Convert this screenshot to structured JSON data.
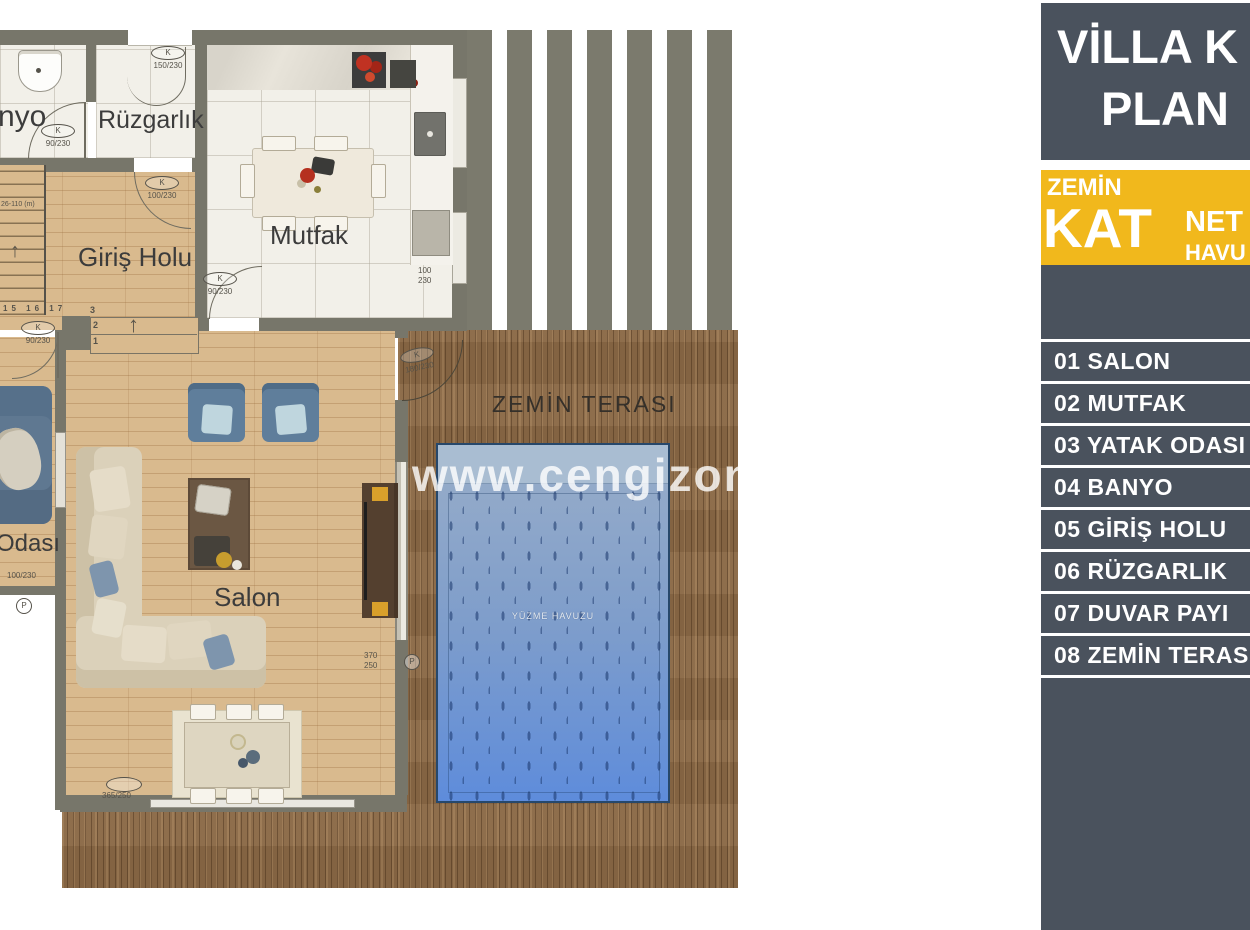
{
  "sidebar": {
    "title_line1": "VİLLA K",
    "title_line2": "PLAN",
    "banner": {
      "floor_word": "ZEMİN",
      "floor_big": "KAT",
      "right_top": "NET",
      "right_bottom": "HAVU"
    },
    "legend": [
      "01 SALON",
      "02 MUTFAK",
      "03 YATAK ODASI",
      "04 BANYO",
      "05 GİRİŞ HOLU",
      "06 RÜZGARLIK",
      "07 DUVAR PAYI",
      "08 ZEMİN TERASI"
    ]
  },
  "plan": {
    "watermark": "www.cengizonay.c",
    "labels": {
      "banyo": "nyo",
      "ruzgarlik": "Rüzgarlık",
      "mutfak": "Mutfak",
      "giris_holu": "Giriş Holu",
      "yatak_odasi": "Odası",
      "salon": "Salon",
      "terrace": "ZEMİN TERASI",
      "pool": "YÜZME HAVUZU"
    },
    "doors": {
      "ruzgarlik_top": {
        "tag": "K",
        "size": "150/230"
      },
      "banyo": {
        "tag": "K",
        "size": "90/230"
      },
      "giris_top": {
        "tag": "K",
        "size": "100/230"
      },
      "giris_bottom": {
        "tag": "K",
        "size": "90/230"
      },
      "mutfak": {
        "tag": "K",
        "size": "90/230"
      },
      "terrace": {
        "tag": "K",
        "size": "180/230"
      }
    },
    "dims": {
      "mutfak_w": "100",
      "mutfak_h": "230",
      "bedroom_window": "100/230",
      "salon_window": "365/250",
      "salon_right_w": "370",
      "salon_right_h": "250",
      "p": "P"
    },
    "stairs": {
      "note": "26-110 (m)",
      "run_numbers": "15 16 17",
      "s3": "3",
      "s2": "2",
      "s1": "1"
    },
    "icons": {
      "up_arrow": "↑"
    }
  },
  "colors": {
    "sidebar_dark": "#4a525d",
    "accent_yellow": "#f1b81c",
    "wall": "#77766a",
    "wood_floor": "#d9ba8e",
    "deck_wood": "#8a6845",
    "pool_blue": "#5e8cdb",
    "pool_ledge": "#a9bdd2",
    "tile": "#f2f0e9"
  }
}
